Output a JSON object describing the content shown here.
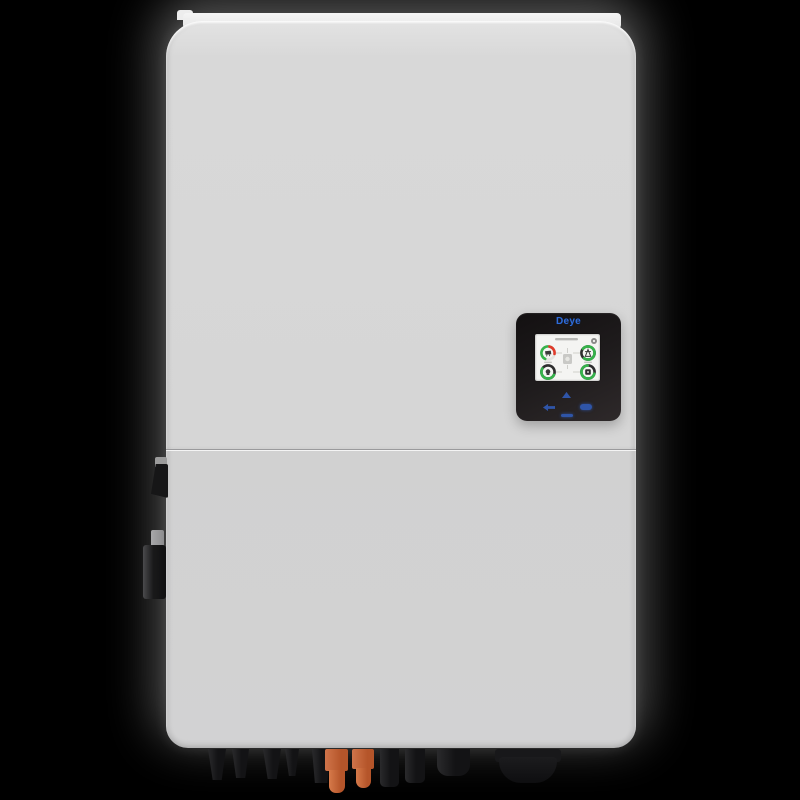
{
  "page": {
    "background_color": "#000000"
  },
  "device": {
    "kind": "hybrid-solar-inverter",
    "panel_color": "#d7d7d7",
    "brand": {
      "text": "Deye",
      "color": "#2e6cd9"
    },
    "display": {
      "bezel_color": "#1e1b1c",
      "lcd_background": "#f4f4f2",
      "status_green": "#35b34a",
      "alert_red": "#e03a2a",
      "key_blue": "#2f55a8",
      "gauges": [
        {
          "name": "pv-gauge",
          "ring": [
            "green",
            "red"
          ],
          "icon": "solar-panel-icon"
        },
        {
          "name": "grid-gauge",
          "ring": [
            "green"
          ],
          "icon": "grid-tower-icon"
        },
        {
          "name": "load-gauge",
          "ring": [
            "green",
            "dark"
          ],
          "icon": "load-icon"
        },
        {
          "name": "battery-gauge",
          "ring": [
            "green",
            "dark"
          ],
          "icon": "battery-icon"
        }
      ],
      "header_icons": [
        "gear-icon"
      ],
      "touch_keys": [
        "up-key",
        "esc-key",
        "enter-key",
        "down-key"
      ]
    },
    "left_side_components": [
      "antenna-port",
      "dc-switch"
    ],
    "bottom_ports": {
      "black_color": "#131315",
      "orange_color": "#c2663a",
      "items": [
        "tapered-plug-1",
        "tapered-plug-2",
        "tapered-plug-3",
        "tapered-plug-4",
        "mc4-plug",
        "orange-terminal-1",
        "orange-terminal-2",
        "black-plug-1",
        "black-plug-2",
        "round-gland",
        "large-gland"
      ]
    }
  }
}
